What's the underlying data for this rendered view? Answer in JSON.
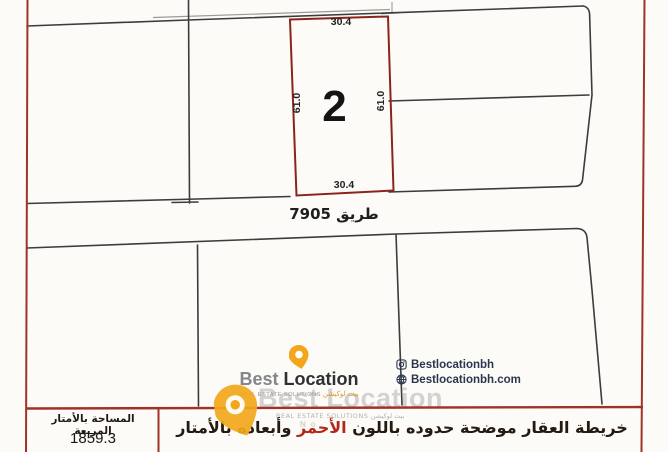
{
  "page": {
    "background": "#fcfbf7"
  },
  "map": {
    "plot_number": "2",
    "dimensions": {
      "top": "30.4",
      "bottom": "30.4",
      "left": "61.0",
      "right": "61.0"
    },
    "road_label": "طريق 7905",
    "colors": {
      "plot_outline_red": "#8b241d",
      "parcel_line_black": "#3c3c3c",
      "page_border_red": "#a03328",
      "double_line_gray": "#9a9a9a"
    }
  },
  "branding": {
    "logo": {
      "best": "Best",
      "location": "Location",
      "tagline_en": "REAL ESTATE SOLUTIONS",
      "tagline_ar": "بيت لوكيشن",
      "pin_color": "#f2a71b"
    },
    "contacts": {
      "instagram": "Bestlocationbh",
      "website": "Bestlocationbh.com"
    },
    "watermark": {
      "line1": "Best Location",
      "line2": "REAL ESTATE SOLUTIONS بيت لوكيشن",
      "line3": "No."
    }
  },
  "footer": {
    "area_label": "المساحة بالأمتار المربعة",
    "area_value": "1859.3",
    "note_before": "خريطة العقار موضحة حدوده باللون ",
    "note_red": "الأحمر",
    "note_after": " وأبعاده بالأمتار"
  }
}
